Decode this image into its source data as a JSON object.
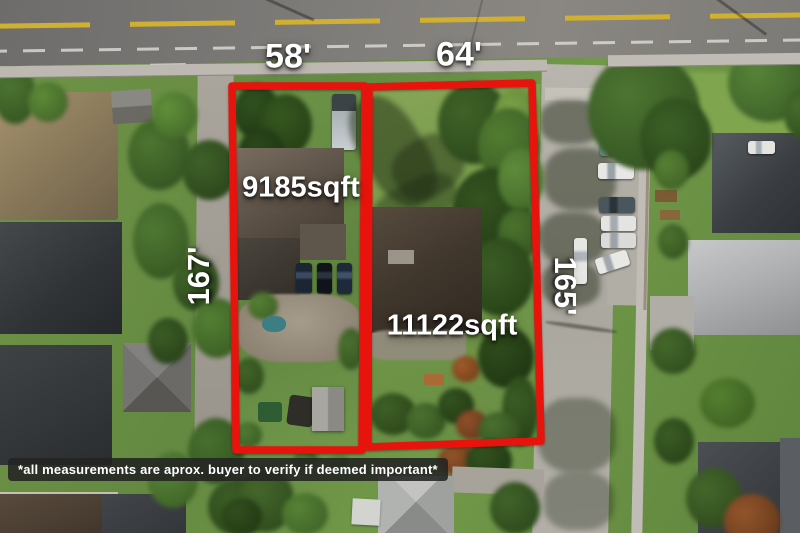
{
  "labels": {
    "lot_left": {
      "frontage": "58'",
      "area": "9185sqft",
      "depth": "167'"
    },
    "lot_right": {
      "frontage": "64'",
      "area": "11122sqft",
      "depth": "165'"
    }
  },
  "disclaimer": {
    "text": "*all measurements are aprox. buyer to verify if deemed important*"
  },
  "colors": {
    "lot_outline": "#e8130d",
    "label_text": "#ffffff",
    "disclaimer_bg": "#232323",
    "road_asphalt": "#7b7976",
    "center_line_yellow": "#d2b02f",
    "lane_line_white": "#d8d8d2"
  }
}
